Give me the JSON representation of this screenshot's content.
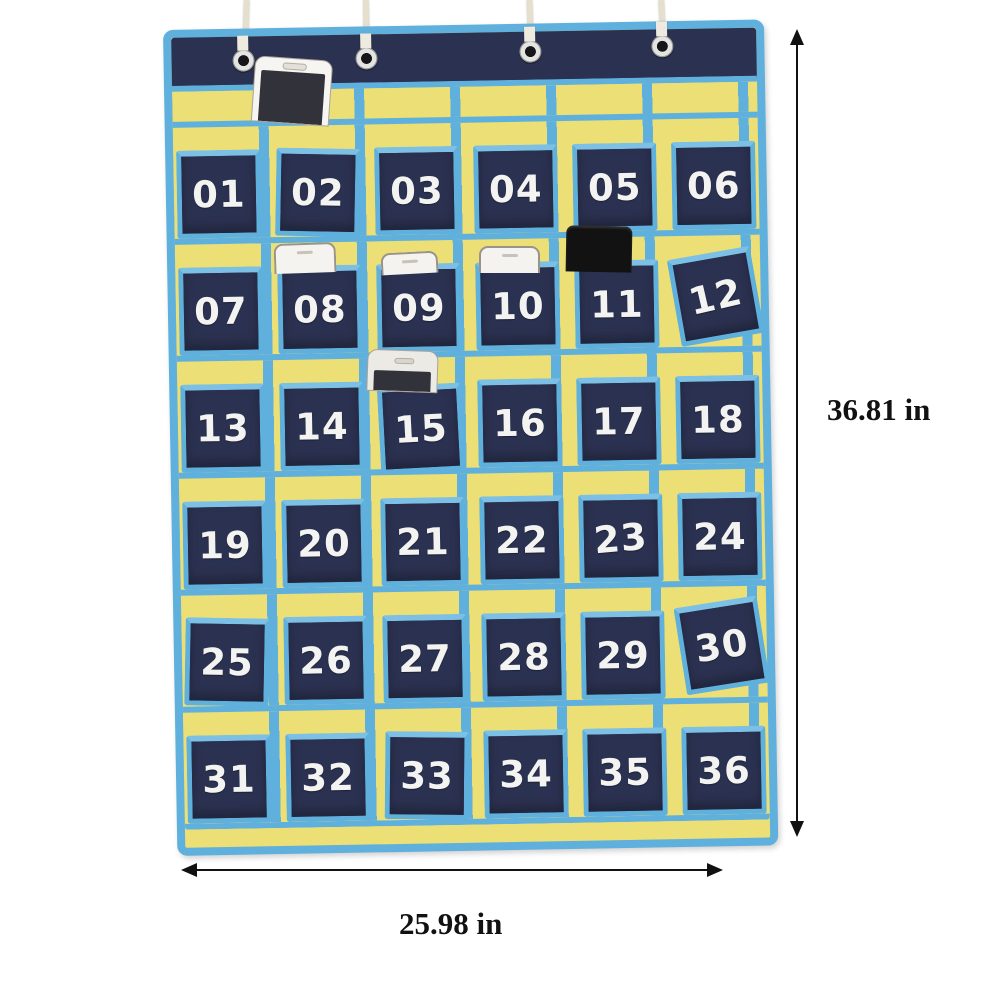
{
  "annotations": {
    "height_label": "36.81 in",
    "width_label": "25.98 in"
  },
  "organizer": {
    "rows": 6,
    "columns": 6,
    "pocket_numbers": [
      "01",
      "02",
      "03",
      "04",
      "05",
      "06",
      "07",
      "08",
      "09",
      "10",
      "11",
      "12",
      "13",
      "14",
      "15",
      "16",
      "17",
      "18",
      "19",
      "20",
      "21",
      "22",
      "23",
      "24",
      "25",
      "26",
      "27",
      "28",
      "29",
      "30",
      "31",
      "32",
      "33",
      "34",
      "35",
      "36"
    ],
    "grommet_count": 4,
    "string_count": 4,
    "phones": [
      {
        "color": "white",
        "style": "large",
        "location": "top-strip-above-02"
      },
      {
        "color": "white",
        "style": "top-edge",
        "location": "pocket-08"
      },
      {
        "color": "white",
        "style": "top-edge",
        "location": "pocket-09"
      },
      {
        "color": "white",
        "style": "top-edge",
        "location": "pocket-10"
      },
      {
        "color": "black",
        "style": "top-edge",
        "location": "pocket-11"
      },
      {
        "color": "silver",
        "style": "large",
        "location": "pocket-15"
      }
    ],
    "colors": {
      "pocket_navy": "#2b3150",
      "trim_blue": "#5fb0dc",
      "backing_yellow": "#ecdf76",
      "number_white": "#f3f3f1",
      "string_cream": "#e7dfcd",
      "annotation_black": "#111111"
    }
  }
}
